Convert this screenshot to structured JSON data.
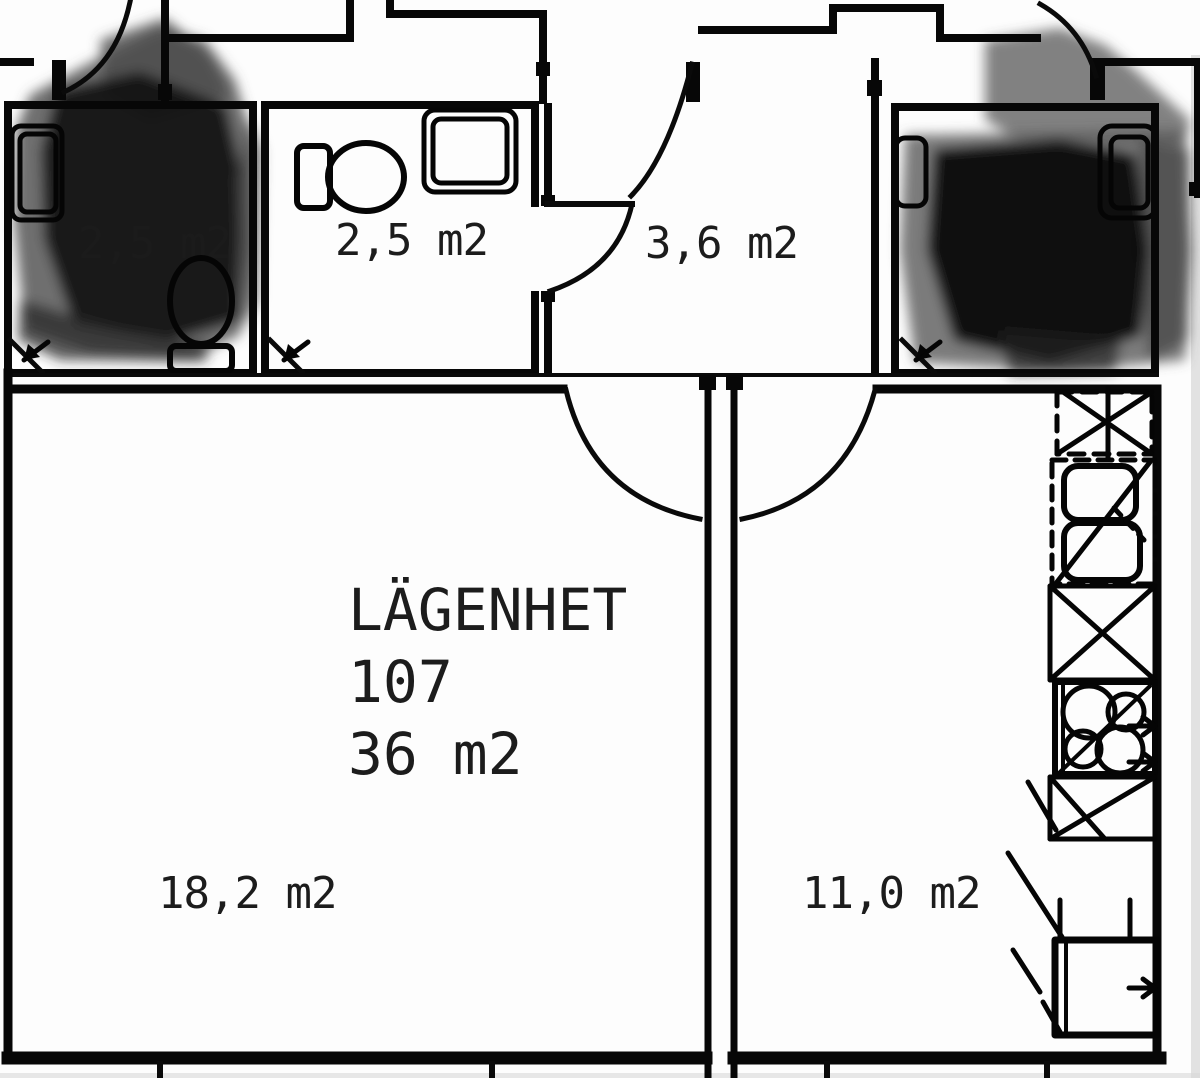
{
  "plan": {
    "title": {
      "line1": "LÄGENHET",
      "line2": "107",
      "line3": "36 m2"
    },
    "rooms": {
      "storage_left": {
        "label": "2,5 m2"
      },
      "bathroom": {
        "label": "2,5 m2"
      },
      "hallway": {
        "label": "3,6 m2"
      },
      "living": {
        "label": "18,2 m2"
      },
      "kitchen": {
        "label": "11,0 m2"
      }
    },
    "colors": {
      "wall": "#070707",
      "background": "#fdfdfd",
      "redaction_dark": "#101010",
      "redaction_gray": "#4a4a4a"
    }
  }
}
